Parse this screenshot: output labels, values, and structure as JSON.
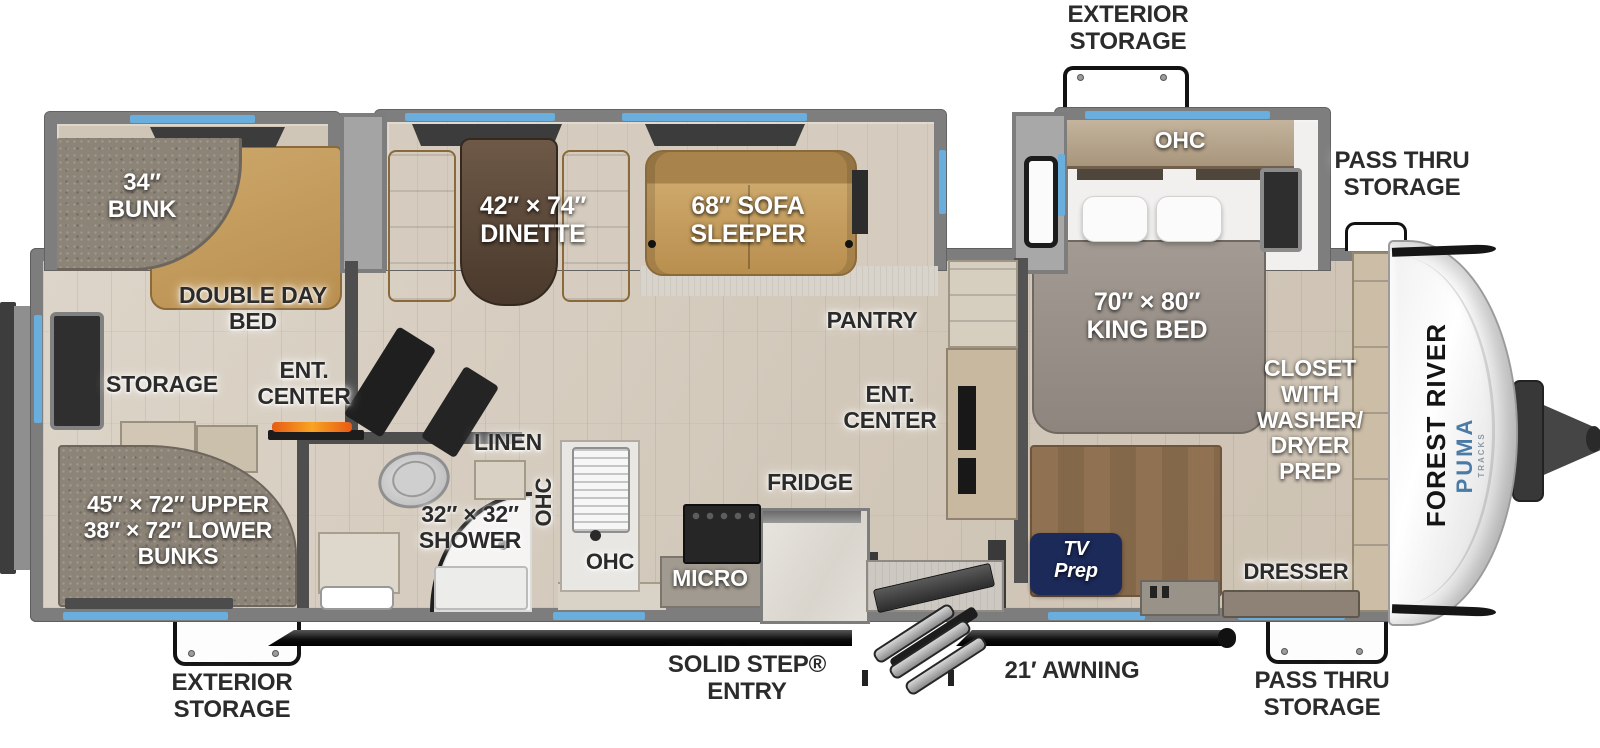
{
  "brand": {
    "manufacturer": "FOREST RIVER",
    "model": "PUMA",
    "series": "TRACKS"
  },
  "colors": {
    "window_accent": "#6aaede",
    "wall_gray": "#7d7d7d",
    "label_dark": "#2b2b2b",
    "tv_prep_badge": "#1c2a5a",
    "furniture_tan": "#c29b5f",
    "brand_blue": "#4a7ba6"
  },
  "callouts": {
    "ext_storage_top": "EXTERIOR\nSTORAGE",
    "pass_thru_top": "PASS THRU\nSTORAGE",
    "ext_storage_bottom": "EXTERIOR\nSTORAGE",
    "solid_step": "SOLID STEP®\nENTRY",
    "awning": "21′ AWNING",
    "pass_thru_bottom": "PASS THRU\nSTORAGE"
  },
  "bunk_room": {
    "bunk": "34″\nBUNK",
    "double_day_bed": "DOUBLE DAY\nBED",
    "storage": "STORAGE",
    "ent_center": "ENT.\nCENTER",
    "bunks": "45″ × 72″ UPPER\n38″ × 72″ LOWER\nBUNKS"
  },
  "living": {
    "dinette": "42″ × 74″\nDINETTE",
    "sofa": "68″ SOFA\nSLEEPER",
    "pantry": "PANTRY",
    "ent_center": "ENT.\nCENTER"
  },
  "bath": {
    "linen": "LINEN",
    "ohc_vertical": "OHC",
    "shower": "32″ × 32″\nSHOWER"
  },
  "kitchen": {
    "ohc": "OHC",
    "micro": "MICRO",
    "fridge": "FRIDGE"
  },
  "bedroom": {
    "ohc": "OHC",
    "king_bed": "70″ × 80″\nKING BED",
    "closet": "CLOSET\nWITH\nWASHER/\nDRYER\nPREP",
    "tv_prep": "TV\nPrep",
    "dresser": "DRESSER"
  }
}
